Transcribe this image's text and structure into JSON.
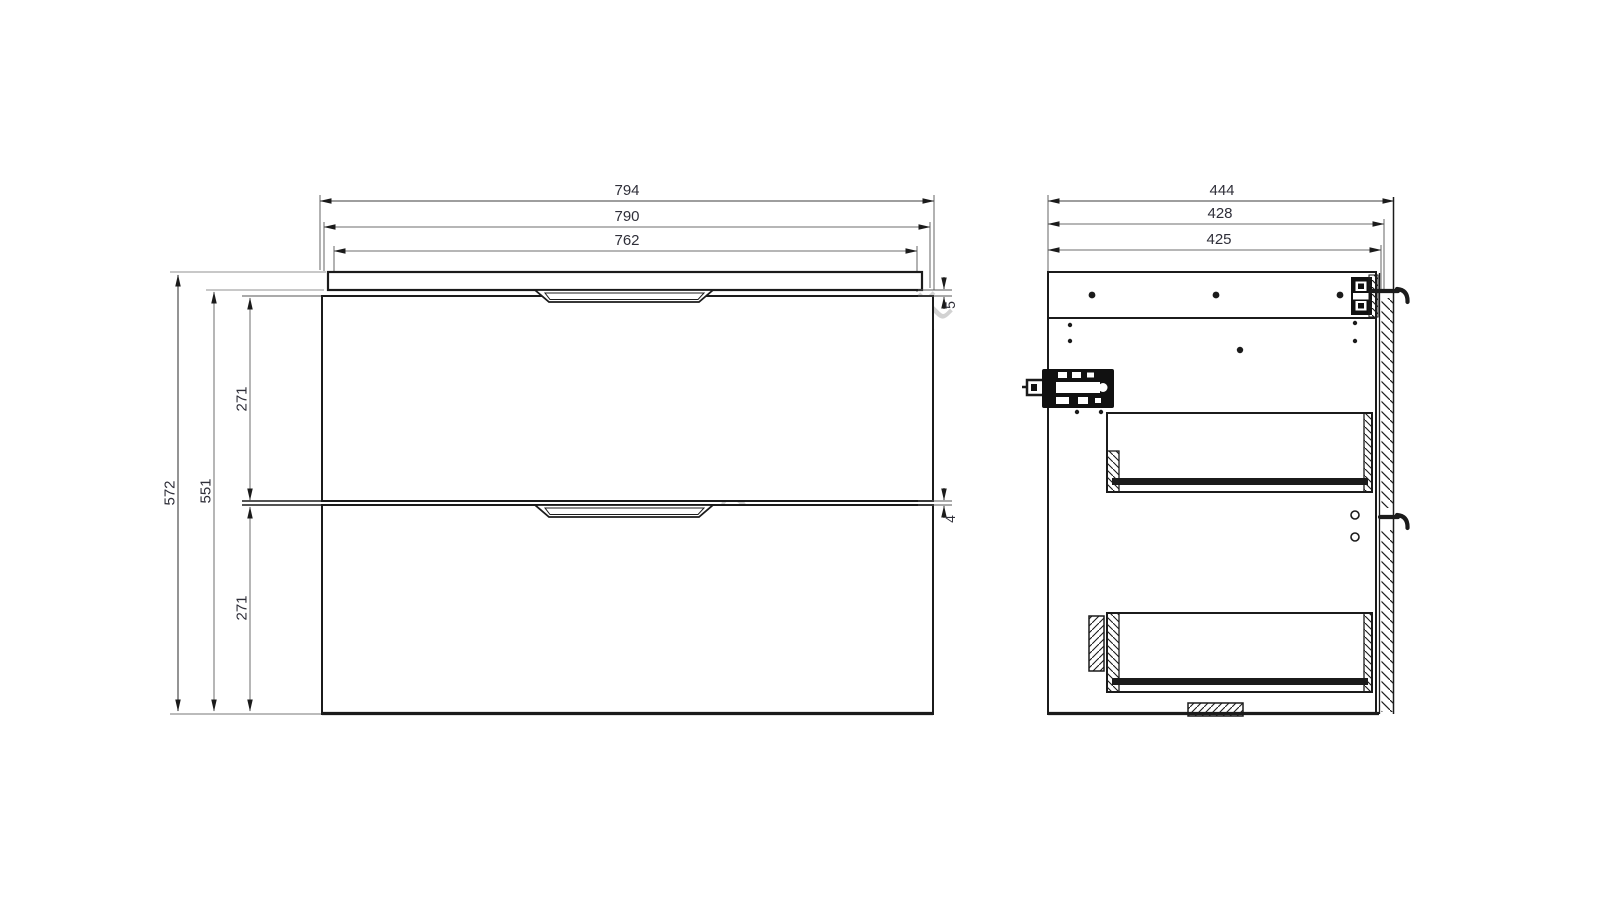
{
  "watermark": {
    "text": "lempumanija.lt",
    "color": "#b5b5b5",
    "angle_deg": -45
  },
  "drawing": {
    "type": "furniture-technical-drawing",
    "line_color": "#1b1b1b",
    "extension_gray": "#a6a6a6",
    "text_color": "#2f2f39",
    "front": {
      "dims_top": [
        {
          "label": "794"
        },
        {
          "label": "790"
        },
        {
          "label": "762"
        }
      ],
      "dims_left": [
        {
          "label": "572"
        },
        {
          "label": "551"
        },
        {
          "label": "271"
        },
        {
          "label": "271"
        }
      ],
      "dims_right": [
        {
          "label": "5"
        },
        {
          "label": "4"
        }
      ]
    },
    "side": {
      "dims_top": [
        {
          "label": "444"
        },
        {
          "label": "428"
        },
        {
          "label": "425"
        }
      ]
    }
  }
}
